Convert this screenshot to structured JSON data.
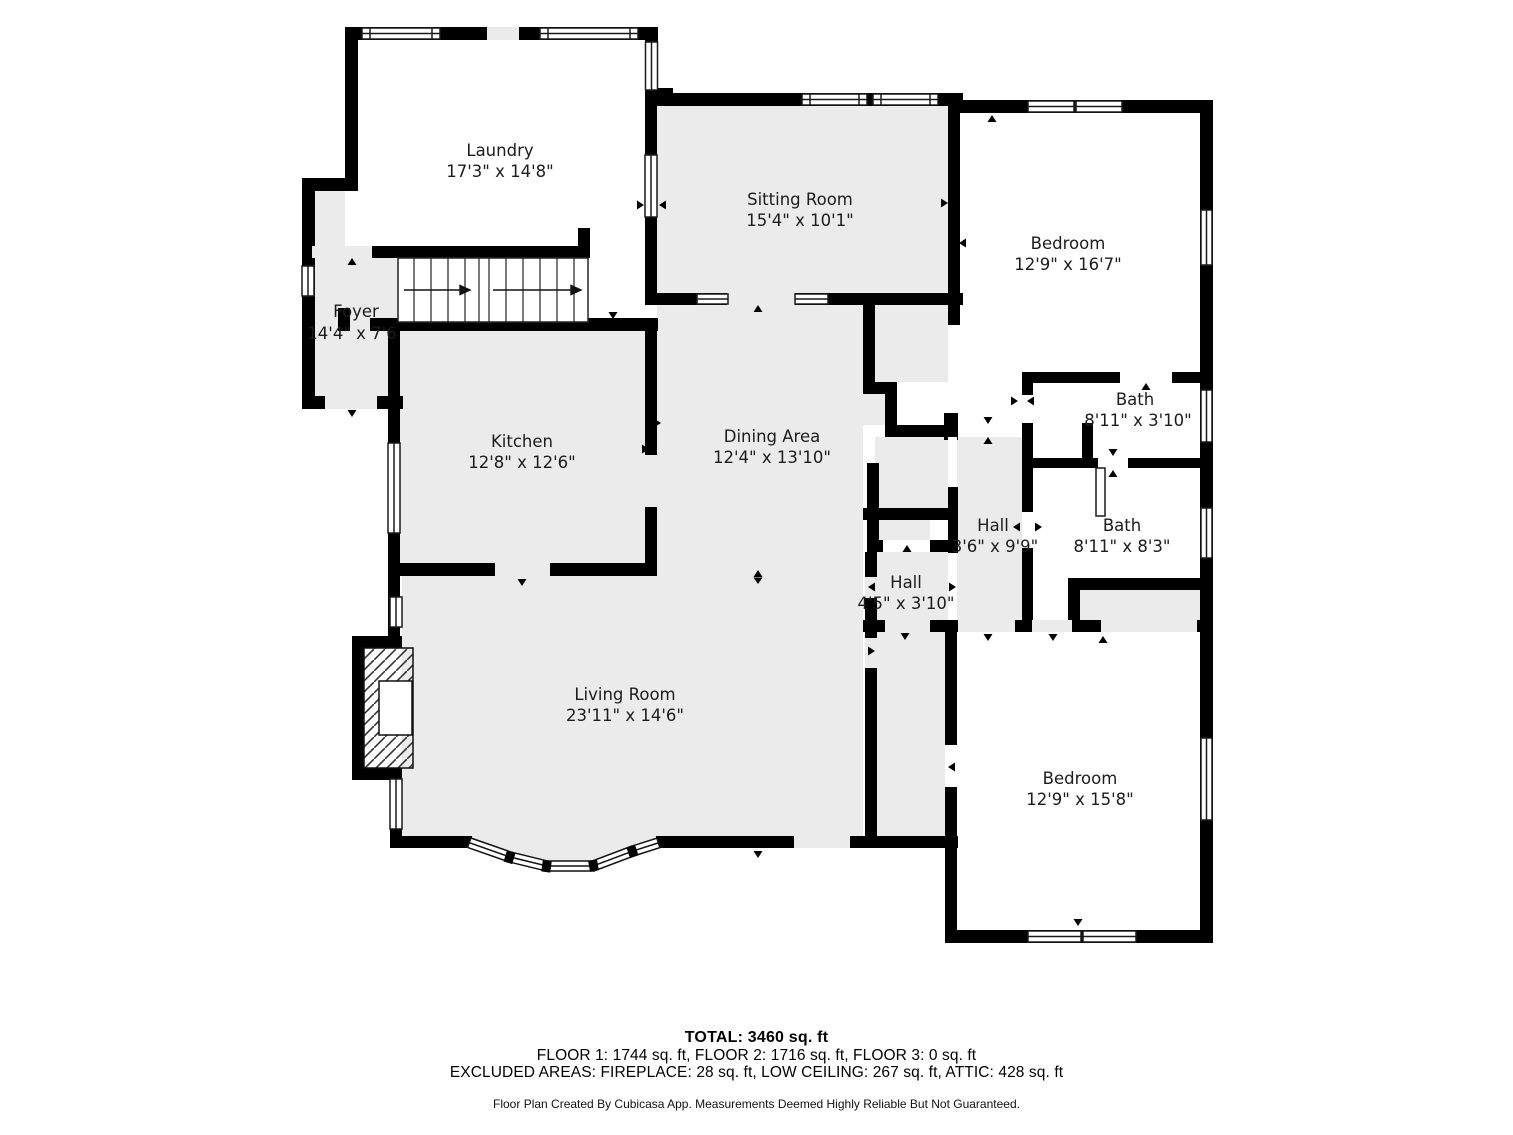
{
  "title": "Floor plan",
  "rooms": [
    {
      "id": "laundry",
      "name": "Laundry",
      "dims": "17'3\" x 14'8\""
    },
    {
      "id": "sitting-room",
      "name": "Sitting Room",
      "dims": "15'4\" x 10'1\""
    },
    {
      "id": "bedroom-top",
      "name": "Bedroom",
      "dims": "12'9\" x 16'7\""
    },
    {
      "id": "foyer",
      "name": "Foyer",
      "dims": "14'4\" x 7'6"
    },
    {
      "id": "kitchen",
      "name": "Kitchen",
      "dims": "12'8\" x 12'6\""
    },
    {
      "id": "dining-area",
      "name": "Dining Area",
      "dims": "12'4\" x 13'10\""
    },
    {
      "id": "bath-small",
      "name": "Bath",
      "dims": "8'11\" x 3'10\""
    },
    {
      "id": "hall-tall",
      "name": "Hall",
      "dims": "3'6\" x 9'9\""
    },
    {
      "id": "bath-large",
      "name": "Bath",
      "dims": "8'11\" x 8'3\""
    },
    {
      "id": "hall-small",
      "name": "Hall",
      "dims": "4'5\" x 3'10\""
    },
    {
      "id": "living-room",
      "name": "Living Room",
      "dims": "23'11\" x 14'6\""
    },
    {
      "id": "bedroom-bottom",
      "name": "Bedroom",
      "dims": "12'9\" x 15'8\""
    }
  ],
  "footer": {
    "total": "TOTAL: 3460 sq. ft",
    "floors": "FLOOR 1: 1744 sq. ft, FLOOR 2: 1716 sq. ft, FLOOR 3: 0 sq. ft",
    "excluded": "EXCLUDED AREAS: FIREPLACE: 28 sq. ft, LOW CEILING: 267 sq. ft, ATTIC: 428 sq. ft",
    "disclaimer": "Floor Plan Created By Cubicasa App. Measurements Deemed Highly Reliable But Not Guaranteed."
  },
  "colors": {
    "wall": "#000000",
    "floor_gray": "#ebebeb",
    "floor_white": "#ffffff",
    "window_outline": "#1a1a1a"
  }
}
